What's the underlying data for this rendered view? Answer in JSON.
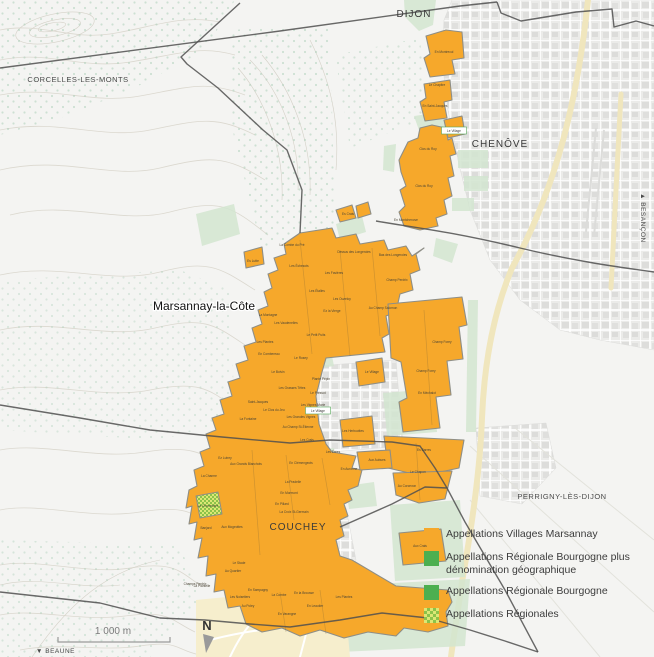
{
  "map": {
    "labels": {
      "dijon": "DIJON",
      "corcelles": "CORCELLES-LES-MONTS",
      "chenove": "CHENÔVE",
      "marsannay": "Marsannay-la-Côte",
      "couchey": "COUCHEY",
      "perrigny": "PERRIGNY-LÈS-DIJON"
    },
    "directions": {
      "besancon": "▲ BESANÇON",
      "beaune": "▼ BEAUNE"
    },
    "scale": {
      "label": "1 000 m"
    },
    "compass": {
      "label": "N"
    },
    "colors": {
      "villages_orange": "#F6A82B",
      "regional_green": "#4CAF50",
      "map_green": "#d2e5d0",
      "checker_green": "#8bc34a",
      "checker_yellow": "#dce775"
    },
    "village_boxes": [
      {
        "t": "Le Village",
        "x": 454,
        "y": 132
      },
      {
        "t": "Le Village",
        "x": 318,
        "y": 412
      }
    ],
    "parcel_labels": [
      {
        "t": "En Montrecul",
        "x": 444,
        "y": 53
      },
      {
        "t": "Le Chapitre",
        "x": 437,
        "y": 86
      },
      {
        "t": "En Saint-Jacques",
        "x": 435,
        "y": 107
      },
      {
        "t": "Clos du Roy",
        "x": 428,
        "y": 150
      },
      {
        "t": "Clos du Roy",
        "x": 424,
        "y": 187,
        "s": 4.2
      },
      {
        "t": "En Montchenove",
        "x": 406,
        "y": 221
      },
      {
        "t": "Es Crais",
        "x": 348,
        "y": 215
      },
      {
        "t": "La Combe du Pré",
        "x": 292,
        "y": 246
      },
      {
        "t": "Es Lutte",
        "x": 253,
        "y": 262
      },
      {
        "t": "Les Échezots",
        "x": 299,
        "y": 267
      },
      {
        "t": "Dessus des Longeroies",
        "x": 354,
        "y": 253
      },
      {
        "t": "Bas des Longeroies",
        "x": 393,
        "y": 256
      },
      {
        "t": "Champ Perdrix",
        "x": 397,
        "y": 281
      },
      {
        "t": "Les Favières",
        "x": 334,
        "y": 274
      },
      {
        "t": "Les Étalles",
        "x": 317,
        "y": 292
      },
      {
        "t": "Les Ouzeloy",
        "x": 342,
        "y": 300
      },
      {
        "t": "Ez la Vierge",
        "x": 332,
        "y": 312
      },
      {
        "t": "Au Champ Salomon",
        "x": 383,
        "y": 309
      },
      {
        "t": "La Montagne",
        "x": 268,
        "y": 316
      },
      {
        "t": "Les Vaudenelles",
        "x": 286,
        "y": 324
      },
      {
        "t": "Le Petit Puits",
        "x": 316,
        "y": 336
      },
      {
        "t": "Les Plantes",
        "x": 265,
        "y": 343
      },
      {
        "t": "En Combereau",
        "x": 269,
        "y": 355
      },
      {
        "t": "Le Rosey",
        "x": 301,
        "y": 359
      },
      {
        "t": "Le Boivin",
        "x": 278,
        "y": 373
      },
      {
        "t": "Plante Pépin",
        "x": 321,
        "y": 380
      },
      {
        "t": "Les Grasses Têtes",
        "x": 292,
        "y": 389
      },
      {
        "t": "Le Pressot",
        "x": 318,
        "y": 394
      },
      {
        "t": "Saint-Jacques",
        "x": 258,
        "y": 403
      },
      {
        "t": "Le Clos du Jeu",
        "x": 274,
        "y": 411
      },
      {
        "t": "Les Vignes Marie",
        "x": 313,
        "y": 406
      },
      {
        "t": "Les Grandes Vignes",
        "x": 301,
        "y": 418
      },
      {
        "t": "La Fontaine",
        "x": 248,
        "y": 420
      },
      {
        "t": "Au Champ St-Étienne",
        "x": 298,
        "y": 428
      },
      {
        "t": "Le Village",
        "x": 372,
        "y": 373
      },
      {
        "t": "Les Herbuottes",
        "x": 353,
        "y": 432
      },
      {
        "t": "Les Crais",
        "x": 307,
        "y": 441
      },
      {
        "t": "Les Érées",
        "x": 333,
        "y": 453
      },
      {
        "t": "Champ Forey",
        "x": 442,
        "y": 343
      },
      {
        "t": "Champ Forey",
        "x": 426,
        "y": 372
      },
      {
        "t": "En Méchalot",
        "x": 427,
        "y": 394
      },
      {
        "t": "Es Barres",
        "x": 424,
        "y": 451
      },
      {
        "t": "Aux Aubues",
        "x": 377,
        "y": 461
      },
      {
        "t": "Le Chapon",
        "x": 418,
        "y": 473
      },
      {
        "t": "Au Corcevon",
        "x": 407,
        "y": 487
      },
      {
        "t": "Ez Lutrey",
        "x": 225,
        "y": 459
      },
      {
        "t": "Aux Grands Blanchots",
        "x": 246,
        "y": 465,
        "s": 2.9
      },
      {
        "t": "En Clémengeots",
        "x": 301,
        "y": 464
      },
      {
        "t": "En Auronne",
        "x": 349,
        "y": 470
      },
      {
        "t": "La Pradelle",
        "x": 293,
        "y": 483
      },
      {
        "t": "En Mormont",
        "x": 289,
        "y": 494
      },
      {
        "t": "En Pillard",
        "x": 282,
        "y": 505
      },
      {
        "t": "La Croix St-Germain",
        "x": 294,
        "y": 513,
        "s": 2.9
      },
      {
        "t": "La Charme",
        "x": 209,
        "y": 477
      },
      {
        "t": "La Chenevière",
        "x": 208,
        "y": 507
      },
      {
        "t": "Banjard",
        "x": 206,
        "y": 529
      },
      {
        "t": "Aux Mogeottes",
        "x": 232,
        "y": 528
      },
      {
        "t": "Champs Perdrix",
        "x": 195,
        "y": 585
      },
      {
        "t": "Le Stade",
        "x": 239,
        "y": 564
      },
      {
        "t": "Au Quartier",
        "x": 233,
        "y": 572
      },
      {
        "t": "La Plantelle",
        "x": 202,
        "y": 587
      },
      {
        "t": "Les Noisetiers",
        "x": 240,
        "y": 598
      },
      {
        "t": "En Sampagny",
        "x": 258,
        "y": 591
      },
      {
        "t": "Au Poley",
        "x": 248,
        "y": 607
      },
      {
        "t": "La Combe",
        "x": 279,
        "y": 596
      },
      {
        "t": "En la Brousse",
        "x": 304,
        "y": 594
      },
      {
        "t": "En Varangne",
        "x": 287,
        "y": 615
      },
      {
        "t": "En Leautier",
        "x": 315,
        "y": 607
      },
      {
        "t": "Les Plantes",
        "x": 344,
        "y": 598
      },
      {
        "t": "Aux Crais",
        "x": 420,
        "y": 547
      }
    ]
  },
  "legend": {
    "items": [
      {
        "label": "Appellations Villages Marsannay",
        "swatch": "orange"
      },
      {
        "label": "Appellations Régionale Bourgogne plus dénomination géographique",
        "swatch": "green"
      },
      {
        "label": "Appellations Régionale Bourgogne",
        "swatch": "green"
      },
      {
        "label": "Appellations Régionales",
        "swatch": "checker"
      }
    ]
  }
}
